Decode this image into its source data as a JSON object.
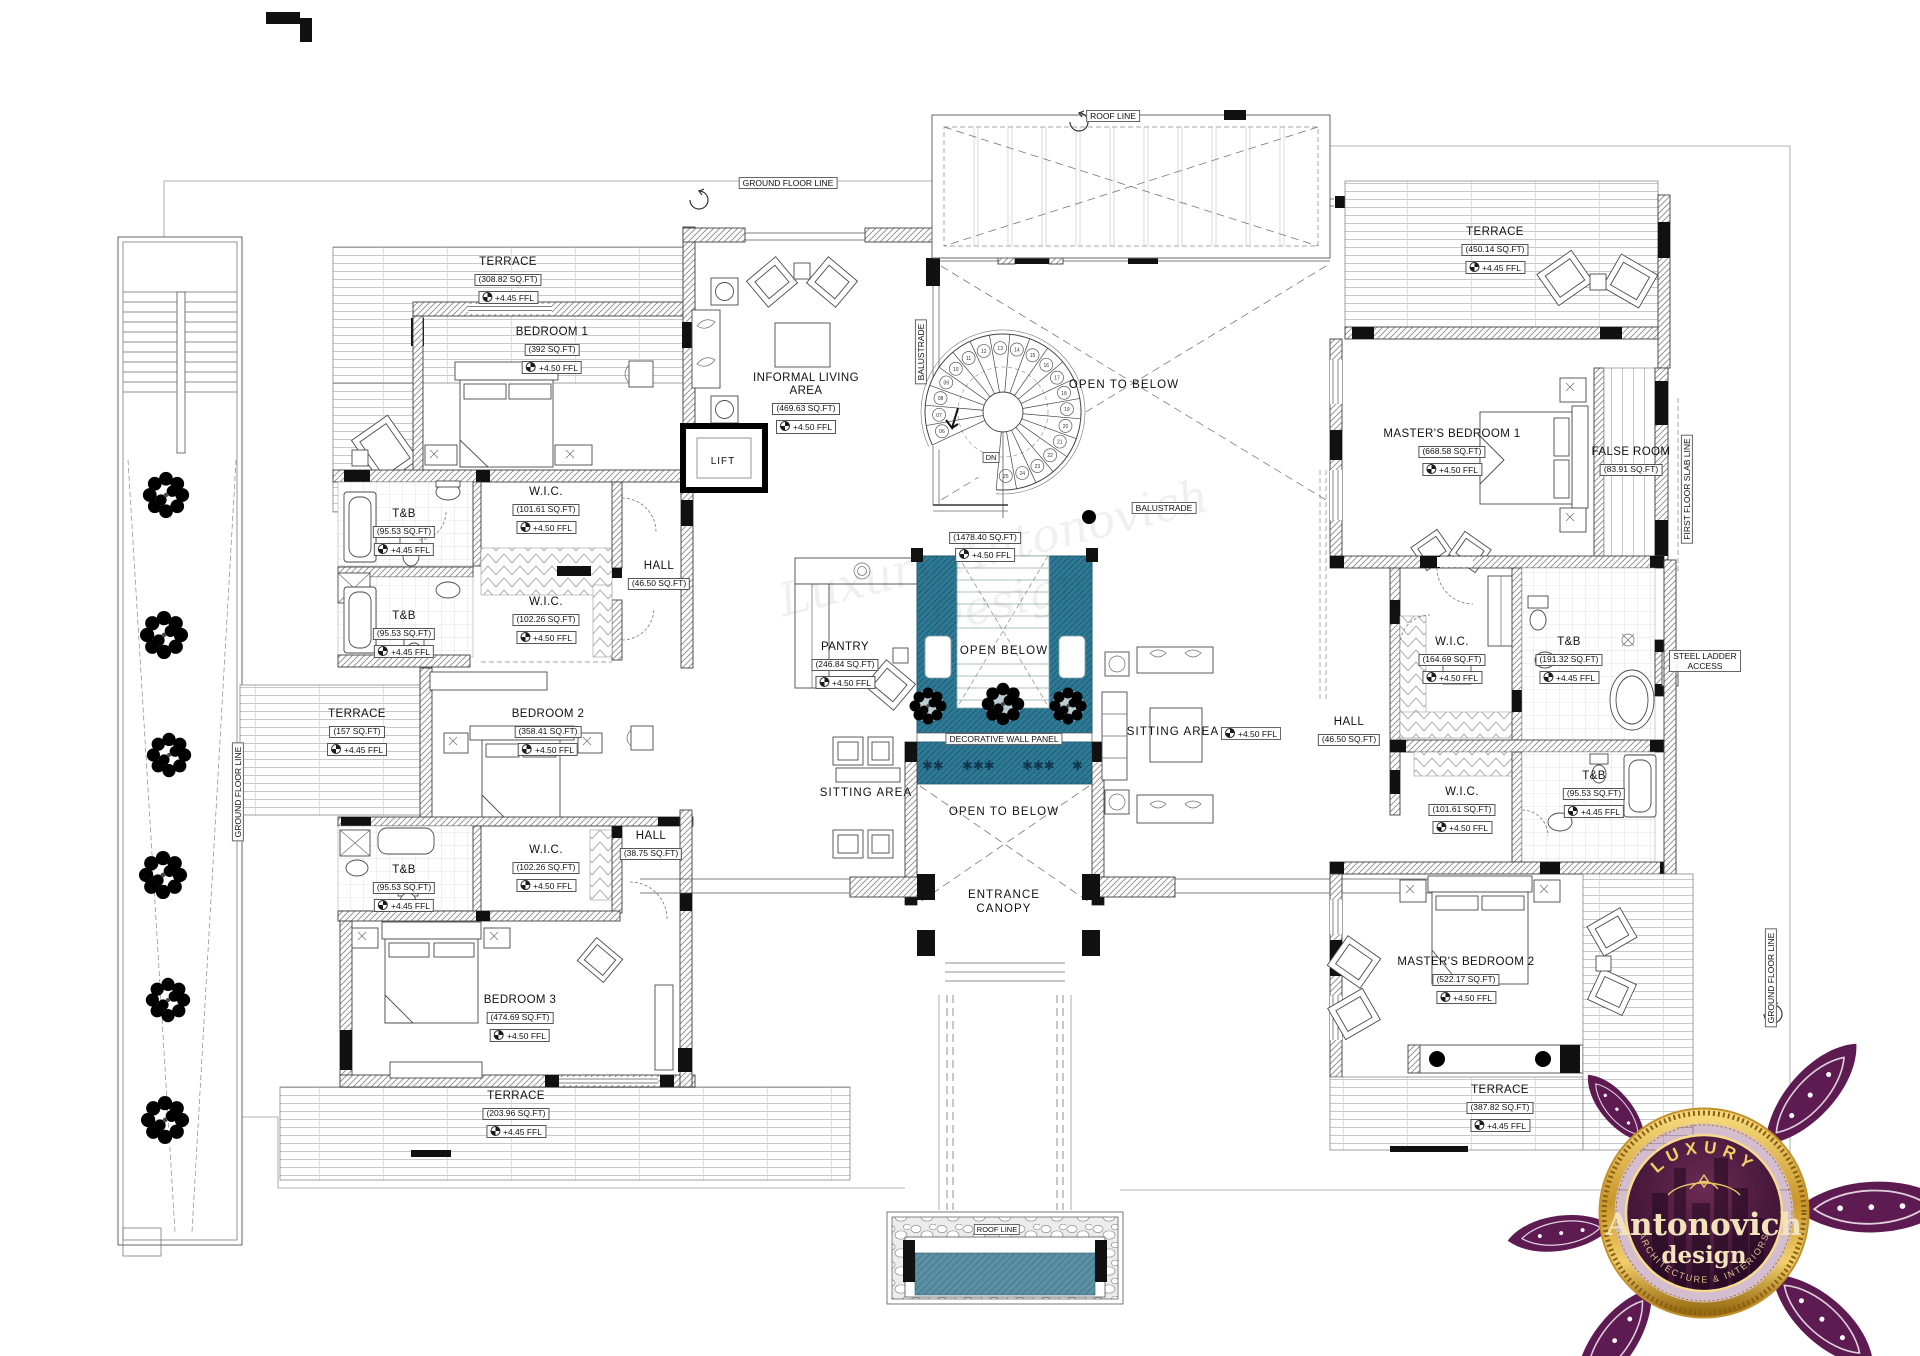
{
  "watermark": {
    "text": "Luxury Antonovich Design"
  },
  "colors": {
    "courtyard_water": "#2e7a95",
    "courtyard_water_dark": "#1d5e78",
    "pool_water": "#5b8fa3",
    "star_accent": "#12384f",
    "logo_purple": "#5e1b52",
    "logo_gold": "#e3b54b",
    "logo_cream": "#f3e3bb"
  },
  "spiral": {
    "start": 6,
    "end": 25
  },
  "rooms": [
    {
      "id": "terrace-top-left",
      "name": "TERRACE",
      "area": "(308.82 SQ.FT)",
      "ffl": "+4.45 FFL",
      "x": 508,
      "y": 256
    },
    {
      "id": "bedroom-1",
      "name": "BEDROOM 1",
      "area": "(392 SQ.FT)",
      "ffl": "+4.50 FFL",
      "x": 552,
      "y": 326
    },
    {
      "id": "informal-living-area",
      "name": "INFORMAL LIVING AREA",
      "area": "(469.63 SQ.FT)",
      "ffl": "+4.50 FFL",
      "x": 806,
      "y": 372,
      "w": 112
    },
    {
      "id": "terrace-top-right",
      "name": "TERRACE",
      "area": "(450.14 SQ.FT)",
      "ffl": "+4.45 FFL",
      "x": 1495,
      "y": 226
    },
    {
      "id": "masters-bedroom-1",
      "name": "MASTER'S BEDROOM 1",
      "area": "(668.58 SQ.FT)",
      "ffl": "+4.50 FFL",
      "x": 1452,
      "y": 428
    },
    {
      "id": "false-room",
      "name": "FALSE ROOM",
      "area": "(83.91 SQ.FT)",
      "x": 1631,
      "y": 446
    },
    {
      "id": "tb-north",
      "name": "T&B",
      "area": "(95.53 SQ.FT)",
      "ffl": "+4.45 FFL",
      "x": 404,
      "y": 508
    },
    {
      "id": "wic-north",
      "name": "W.I.C.",
      "area": "(101.61 SQ.FT)",
      "ffl": "+4.50 FFL",
      "x": 546,
      "y": 486
    },
    {
      "id": "hall-upper-left",
      "name": "HALL",
      "area": "(46.50 SQ.FT)",
      "x": 659,
      "y": 560
    },
    {
      "id": "tb-mid",
      "name": "T&B",
      "area": "(95.53 SQ.FT)",
      "ffl": "+4.45 FFL",
      "x": 404,
      "y": 610
    },
    {
      "id": "wic-mid",
      "name": "W.I.C.",
      "area": "(102.26 SQ.FT)",
      "ffl": "+4.50 FFL",
      "x": 546,
      "y": 596
    },
    {
      "id": "first-floor-hall",
      "area": "(1478.40 SQ.FT)",
      "ffl": "+4.50 FFL",
      "x": 985,
      "y": 527
    },
    {
      "id": "terrace-157",
      "name": "TERRACE",
      "area": "(157 SQ.FT)",
      "ffl": "+4.45 FFL",
      "x": 357,
      "y": 708
    },
    {
      "id": "bedroom-2",
      "name": "BEDROOM 2",
      "area": "(358.41 SQ.FT)",
      "ffl": "+4.50 FFL",
      "x": 548,
      "y": 708
    },
    {
      "id": "pantry",
      "name": "PANTRY",
      "area": "(246.84 SQ.FT)",
      "ffl": "+4.50 FFL",
      "x": 845,
      "y": 641
    },
    {
      "id": "hall-right",
      "name": "HALL",
      "area": "(46.50 SQ.FT)",
      "x": 1349,
      "y": 716
    },
    {
      "id": "wic-master1",
      "name": "W.I.C.",
      "area": "(164.69 SQ.FT)",
      "ffl": "+4.50 FFL",
      "x": 1452,
      "y": 636
    },
    {
      "id": "tb-master1",
      "name": "T&B",
      "area": "(191.32 SQ.FT)",
      "ffl": "+4.45 FFL",
      "x": 1569,
      "y": 636
    },
    {
      "id": "wic-master2",
      "name": "W.I.C.",
      "area": "(101.61 SQ.FT)",
      "ffl": "+4.50 FFL",
      "x": 1462,
      "y": 786
    },
    {
      "id": "tb-master2",
      "name": "T&B",
      "area": "(95.53 SQ.FT)",
      "ffl": "+4.45 FFL",
      "x": 1594,
      "y": 770
    },
    {
      "id": "hall-lower-left",
      "name": "HALL",
      "area": "(38.75 SQ.FT)",
      "x": 651,
      "y": 830
    },
    {
      "id": "wic-south",
      "name": "W.I.C.",
      "area": "(102.26 SQ.FT)",
      "ffl": "+4.50 FFL",
      "x": 546,
      "y": 844
    },
    {
      "id": "tb-south",
      "name": "T&B",
      "area": "(95.53 SQ.FT)",
      "ffl": "+4.45 FFL",
      "x": 404,
      "y": 864
    },
    {
      "id": "bedroom-3",
      "name": "BEDROOM 3",
      "area": "(474.69 SQ.FT)",
      "ffl": "+4.50 FFL",
      "x": 520,
      "y": 994
    },
    {
      "id": "terrace-bottom-left",
      "name": "TERRACE",
      "area": "(203.96 SQ.FT)",
      "ffl": "+4.45 FFL",
      "x": 516,
      "y": 1090
    },
    {
      "id": "masters-bedroom-2",
      "name": "MASTER'S BEDROOM 2",
      "area": "(522.17 SQ.FT)",
      "ffl": "+4.50 FFL",
      "x": 1466,
      "y": 956
    },
    {
      "id": "terrace-bottom-right",
      "name": "TERRACE",
      "area": "(387.82 SQ.FT)",
      "ffl": "+4.45 FFL",
      "x": 1500,
      "y": 1084
    }
  ],
  "annotations": [
    {
      "id": "roof-line",
      "text": "ROOF LINE",
      "x": 1113,
      "y": 110,
      "style": "boxed"
    },
    {
      "id": "ground-floor-line-top",
      "text": "GROUND FLOOR LINE",
      "x": 788,
      "y": 177,
      "style": "boxed"
    },
    {
      "id": "ground-floor-line-left",
      "text": "GROUND FLOOR LINE",
      "x": 238,
      "y": 792,
      "style": "boxed rot"
    },
    {
      "id": "ground-floor-line-right",
      "text": "GROUND FLOOR LINE",
      "x": 1771,
      "y": 978,
      "style": "boxed rot"
    },
    {
      "id": "balustrade-left",
      "text": "BALUSTRADE",
      "x": 921,
      "y": 352,
      "style": "boxed rot"
    },
    {
      "id": "balustrade-mid",
      "text": "BALUSTRADE",
      "x": 1164,
      "y": 502,
      "style": "boxed"
    },
    {
      "id": "first-floor-slab-line",
      "text": "FIRST FLOOR SLAB LINE",
      "x": 1687,
      "y": 489,
      "style": "boxed rot"
    },
    {
      "id": "steel-ladder-access",
      "text": "STEEL LADDER ACCESS",
      "x": 1705,
      "y": 650,
      "style": "boxed wrap",
      "w": 64
    },
    {
      "id": "decorative-wall-panel",
      "text": "DECORATIVE WALL PANEL",
      "x": 1004,
      "y": 733,
      "style": "boxed"
    },
    {
      "id": "open-to-below-top",
      "text": "OPEN TO BELOW",
      "x": 1124,
      "y": 379,
      "style": "big"
    },
    {
      "id": "open-below",
      "text": "OPEN BELOW",
      "x": 1004,
      "y": 645,
      "style": "big"
    },
    {
      "id": "open-to-below-bottom",
      "text": "OPEN TO BELOW",
      "x": 1004,
      "y": 806,
      "style": "big"
    },
    {
      "id": "entrance-canopy",
      "text": "ENTRANCE CANOPY",
      "x": 1004,
      "y": 889,
      "style": "big wrap",
      "w": 96
    },
    {
      "id": "sitting-area-left",
      "text": "SITTING AREA",
      "x": 866,
      "y": 787,
      "style": "big"
    },
    {
      "id": "sitting-area-right",
      "text": "SITTING AREA",
      "x": 1173,
      "y": 726,
      "style": "big"
    },
    {
      "id": "sitting-area-ffl",
      "text": "+4.50 FFL",
      "x": 1251,
      "y": 727,
      "style": "boxed",
      "ffl": true
    },
    {
      "id": "lift",
      "text": "LIFT",
      "x": 723,
      "y": 456,
      "style": "plain"
    },
    {
      "id": "dn",
      "text": "DN",
      "x": 991,
      "y": 452,
      "style": "boxed tiny"
    },
    {
      "id": "pool-roof-line",
      "text": "ROOF LINE",
      "x": 997,
      "y": 1224,
      "style": "boxed tiny"
    }
  ],
  "logo": {
    "luxury": "LUXURY",
    "brand": "Antonovich",
    "sub": "design",
    "tagline": "ARCHITECTURE & INTERIORS"
  }
}
